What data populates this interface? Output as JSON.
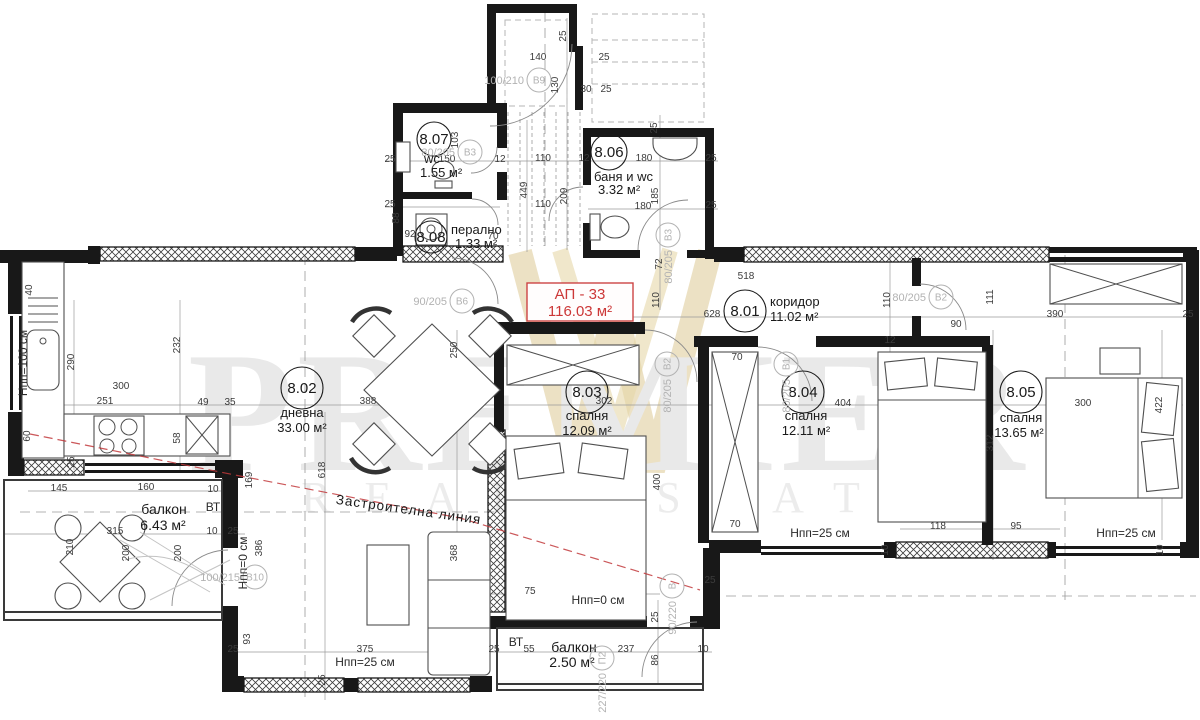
{
  "plan": {
    "id": "АП - 33",
    "area": "116.03 м²"
  },
  "watermark": {
    "line1": "PREMIER",
    "line2": "REAL ESTATE"
  },
  "colors": {
    "wall": "#181818",
    "accent_red": "#cc3838",
    "gold": "#ddc994",
    "watermark_gray": "#e9e9e9"
  },
  "rooms": [
    {
      "num": "8.01",
      "name": "коридор",
      "area": "11.02 м²",
      "cx": 745,
      "cy": 311,
      "r": 21,
      "nx": 770,
      "ny": 306,
      "ax": 770,
      "ay": 321,
      "anchor": "start"
    },
    {
      "num": "8.02",
      "name": "дневна",
      "area": "33.00 м²",
      "cx": 302,
      "cy": 388,
      "r": 21,
      "nx": 302,
      "ny": 417,
      "ax": 302,
      "ay": 432,
      "anchor": "middle"
    },
    {
      "num": "8.03",
      "name": "спалня",
      "area": "12.09 м²",
      "cx": 587,
      "cy": 392,
      "r": 21,
      "nx": 587,
      "ny": 420,
      "ax": 587,
      "ay": 435,
      "anchor": "middle"
    },
    {
      "num": "8.04",
      "name": "спалня",
      "area": "12.11 м²",
      "cx": 803,
      "cy": 392,
      "r": 21,
      "nx": 806,
      "ny": 420,
      "ax": 806,
      "ay": 435,
      "anchor": "middle"
    },
    {
      "num": "8.05",
      "name": "спалня",
      "area": "13.65 м²",
      "cx": 1021,
      "cy": 392,
      "r": 21,
      "nx": 1021,
      "ny": 422,
      "ax": 1019,
      "ay": 437,
      "anchor": "middle"
    },
    {
      "num": "8.06",
      "name": "баня и wc",
      "area": "3.32 м²",
      "cx": 609,
      "cy": 152,
      "r": 18,
      "nx": 594,
      "ny": 181,
      "ax": 598,
      "ay": 194,
      "anchor": "start"
    },
    {
      "num": "8.07",
      "name": "wc",
      "area": "1.55 м²",
      "cx": 434,
      "cy": 139,
      "r": 17,
      "nx": 424,
      "ny": 163,
      "ax": 420,
      "ay": 177,
      "anchor": "start"
    },
    {
      "num": "8.08",
      "name": "перално",
      "area": "1.33 м²",
      "cx": 431,
      "cy": 237,
      "r": 16,
      "nx": 451,
      "ny": 234,
      "ax": 455,
      "ay": 248,
      "anchor": "start"
    }
  ],
  "balconies": [
    {
      "name": "балкон",
      "area": "6.43 м²",
      "nx": 164,
      "ny": 514,
      "ax": 163,
      "ay": 530
    },
    {
      "name": "балкон",
      "area": "2.50 м²",
      "nx": 574,
      "ny": 652,
      "ax": 572,
      "ay": 667
    }
  ],
  "notes": [
    {
      "t": "Застроителна линия",
      "x": 408,
      "y": 514,
      "rot": 8,
      "big": 1
    },
    {
      "t": "Нпп=25 см",
      "x": 365,
      "y": 666
    },
    {
      "t": "Нпп=25 см",
      "x": 820,
      "y": 537
    },
    {
      "t": "Нпп=25 см",
      "x": 1126,
      "y": 537
    },
    {
      "t": "Нпп=0 см",
      "x": 598,
      "y": 604
    },
    {
      "t": "Нпп=0 см",
      "x": 247,
      "y": 563,
      "rot": -90
    },
    {
      "t": "Нпп=100 см",
      "x": 27,
      "y": 363,
      "rot": -90
    },
    {
      "t": "ВТ",
      "x": 213,
      "y": 511
    },
    {
      "t": "ВТ",
      "x": 516,
      "y": 646
    }
  ],
  "door_tags": [
    {
      "tag": "В9",
      "size": "100/210",
      "x": 539,
      "y": 80
    },
    {
      "tag": "В3",
      "size": "80/205",
      "x": 470,
      "y": 152
    },
    {
      "tag": "В3",
      "size": "80/205",
      "x": 668,
      "y": 235,
      "rot": 1
    },
    {
      "tag": "В6",
      "size": "90/205",
      "x": 462,
      "y": 301
    },
    {
      "tag": "В2",
      "size": "80/205",
      "x": 667,
      "y": 364,
      "rot": 1
    },
    {
      "tag": "В1",
      "size": "80/205",
      "x": 786,
      "y": 364,
      "rot": 1
    },
    {
      "tag": "В2",
      "size": "80/205",
      "x": 941,
      "y": 297
    },
    {
      "tag": "В10",
      "size": "100/215",
      "x": 255,
      "y": 577
    },
    {
      "tag": "В",
      "size": "90/220",
      "x": 672,
      "y": 586,
      "rot": 1
    },
    {
      "tag": "П2",
      "size": "227/220",
      "x": 602,
      "y": 658,
      "rot": 1
    }
  ],
  "dimensions": [
    {
      "t": "140",
      "x": 538,
      "y": 60
    },
    {
      "t": "25",
      "x": 566,
      "y": 36,
      "v": 1
    },
    {
      "t": "25",
      "x": 604,
      "y": 60
    },
    {
      "t": "130",
      "x": 558,
      "y": 85,
      "v": 1
    },
    {
      "t": "30",
      "x": 586,
      "y": 92
    },
    {
      "t": "25",
      "x": 606,
      "y": 92
    },
    {
      "t": "25",
      "x": 657,
      "y": 128,
      "v": 1
    },
    {
      "t": "25",
      "x": 390,
      "y": 162
    },
    {
      "t": "103",
      "x": 458,
      "y": 140,
      "v": 1
    },
    {
      "t": "150",
      "x": 447,
      "y": 162
    },
    {
      "t": "12",
      "x": 500,
      "y": 162
    },
    {
      "t": "110",
      "x": 543,
      "y": 161
    },
    {
      "t": "12",
      "x": 584,
      "y": 161
    },
    {
      "t": "180",
      "x": 644,
      "y": 161
    },
    {
      "t": "25",
      "x": 711,
      "y": 161
    },
    {
      "t": "449",
      "x": 527,
      "y": 190,
      "v": 1
    },
    {
      "t": "209",
      "x": 567,
      "y": 196,
      "v": 1
    },
    {
      "t": "185",
      "x": 658,
      "y": 196,
      "v": 1
    },
    {
      "t": "25",
      "x": 390,
      "y": 207
    },
    {
      "t": "88",
      "x": 399,
      "y": 218,
      "v": 1
    },
    {
      "t": "110",
      "x": 543,
      "y": 207
    },
    {
      "t": "180",
      "x": 643,
      "y": 209
    },
    {
      "t": "25",
      "x": 711,
      "y": 208
    },
    {
      "t": "92",
      "x": 410,
      "y": 237
    },
    {
      "t": "70",
      "x": 493,
      "y": 239
    },
    {
      "t": "72",
      "x": 662,
      "y": 264,
      "v": 1
    },
    {
      "t": "518",
      "x": 746,
      "y": 279
    },
    {
      "t": "110",
      "x": 659,
      "y": 300,
      "v": 1
    },
    {
      "t": "628",
      "x": 712,
      "y": 317
    },
    {
      "t": "110",
      "x": 890,
      "y": 300,
      "v": 1
    },
    {
      "t": "111",
      "x": 993,
      "y": 297,
      "v": 1
    },
    {
      "t": "90",
      "x": 956,
      "y": 327
    },
    {
      "t": "390",
      "x": 1055,
      "y": 317
    },
    {
      "t": "25",
      "x": 1188,
      "y": 317
    },
    {
      "t": "12",
      "x": 890,
      "y": 343
    },
    {
      "t": "40",
      "x": 32,
      "y": 290,
      "v": 1
    },
    {
      "t": "290",
      "x": 74,
      "y": 362,
      "v": 1
    },
    {
      "t": "232",
      "x": 180,
      "y": 345,
      "v": 1
    },
    {
      "t": "300",
      "x": 121,
      "y": 389
    },
    {
      "t": "251",
      "x": 105,
      "y": 404
    },
    {
      "t": "49",
      "x": 203,
      "y": 405
    },
    {
      "t": "35",
      "x": 230,
      "y": 405
    },
    {
      "t": "58",
      "x": 180,
      "y": 438,
      "v": 1
    },
    {
      "t": "60",
      "x": 30,
      "y": 436,
      "v": 1
    },
    {
      "t": "25",
      "x": 74,
      "y": 462,
      "v": 1
    },
    {
      "t": "388",
      "x": 368,
      "y": 404
    },
    {
      "t": "618",
      "x": 325,
      "y": 470,
      "v": 1
    },
    {
      "t": "250",
      "x": 457,
      "y": 350,
      "v": 1
    },
    {
      "t": "302",
      "x": 604,
      "y": 404
    },
    {
      "t": "400",
      "x": 660,
      "y": 482,
      "v": 1
    },
    {
      "t": "70",
      "x": 737,
      "y": 360
    },
    {
      "t": "70",
      "x": 735,
      "y": 527
    },
    {
      "t": "404",
      "x": 843,
      "y": 406
    },
    {
      "t": "300",
      "x": 1083,
      "y": 406
    },
    {
      "t": "312",
      "x": 993,
      "y": 443,
      "v": 1
    },
    {
      "t": "422",
      "x": 1162,
      "y": 405,
      "v": 1
    },
    {
      "t": "145",
      "x": 59,
      "y": 491
    },
    {
      "t": "160",
      "x": 146,
      "y": 490
    },
    {
      "t": "10",
      "x": 213,
      "y": 492
    },
    {
      "t": "169",
      "x": 252,
      "y": 480,
      "v": 1
    },
    {
      "t": "315",
      "x": 115,
      "y": 534
    },
    {
      "t": "10",
      "x": 212,
      "y": 534
    },
    {
      "t": "25",
      "x": 233,
      "y": 534
    },
    {
      "t": "210",
      "x": 73,
      "y": 547,
      "v": 1
    },
    {
      "t": "200",
      "x": 129,
      "y": 553,
      "v": 1
    },
    {
      "t": "200",
      "x": 181,
      "y": 553,
      "v": 1
    },
    {
      "t": "386",
      "x": 262,
      "y": 548,
      "v": 1
    },
    {
      "t": "93",
      "x": 250,
      "y": 639,
      "v": 1
    },
    {
      "t": "368",
      "x": 457,
      "y": 553,
      "v": 1
    },
    {
      "t": "118",
      "x": 938,
      "y": 529
    },
    {
      "t": "95",
      "x": 1016,
      "y": 529
    },
    {
      "t": "10",
      "x": 888,
      "y": 550,
      "v": 1
    },
    {
      "t": "10",
      "x": 1163,
      "y": 550,
      "v": 1
    },
    {
      "t": "75",
      "x": 530,
      "y": 594
    },
    {
      "t": "25",
      "x": 658,
      "y": 617,
      "v": 1
    },
    {
      "t": "25",
      "x": 710,
      "y": 583
    },
    {
      "t": "25",
      "x": 233,
      "y": 652
    },
    {
      "t": "375",
      "x": 365,
      "y": 652
    },
    {
      "t": "25",
      "x": 325,
      "y": 680,
      "v": 1
    },
    {
      "t": "55",
      "x": 529,
      "y": 652
    },
    {
      "t": "25",
      "x": 494,
      "y": 652
    },
    {
      "t": "237",
      "x": 626,
      "y": 652
    },
    {
      "t": "86",
      "x": 658,
      "y": 660,
      "v": 1
    },
    {
      "t": "10",
      "x": 703,
      "y": 652
    }
  ]
}
